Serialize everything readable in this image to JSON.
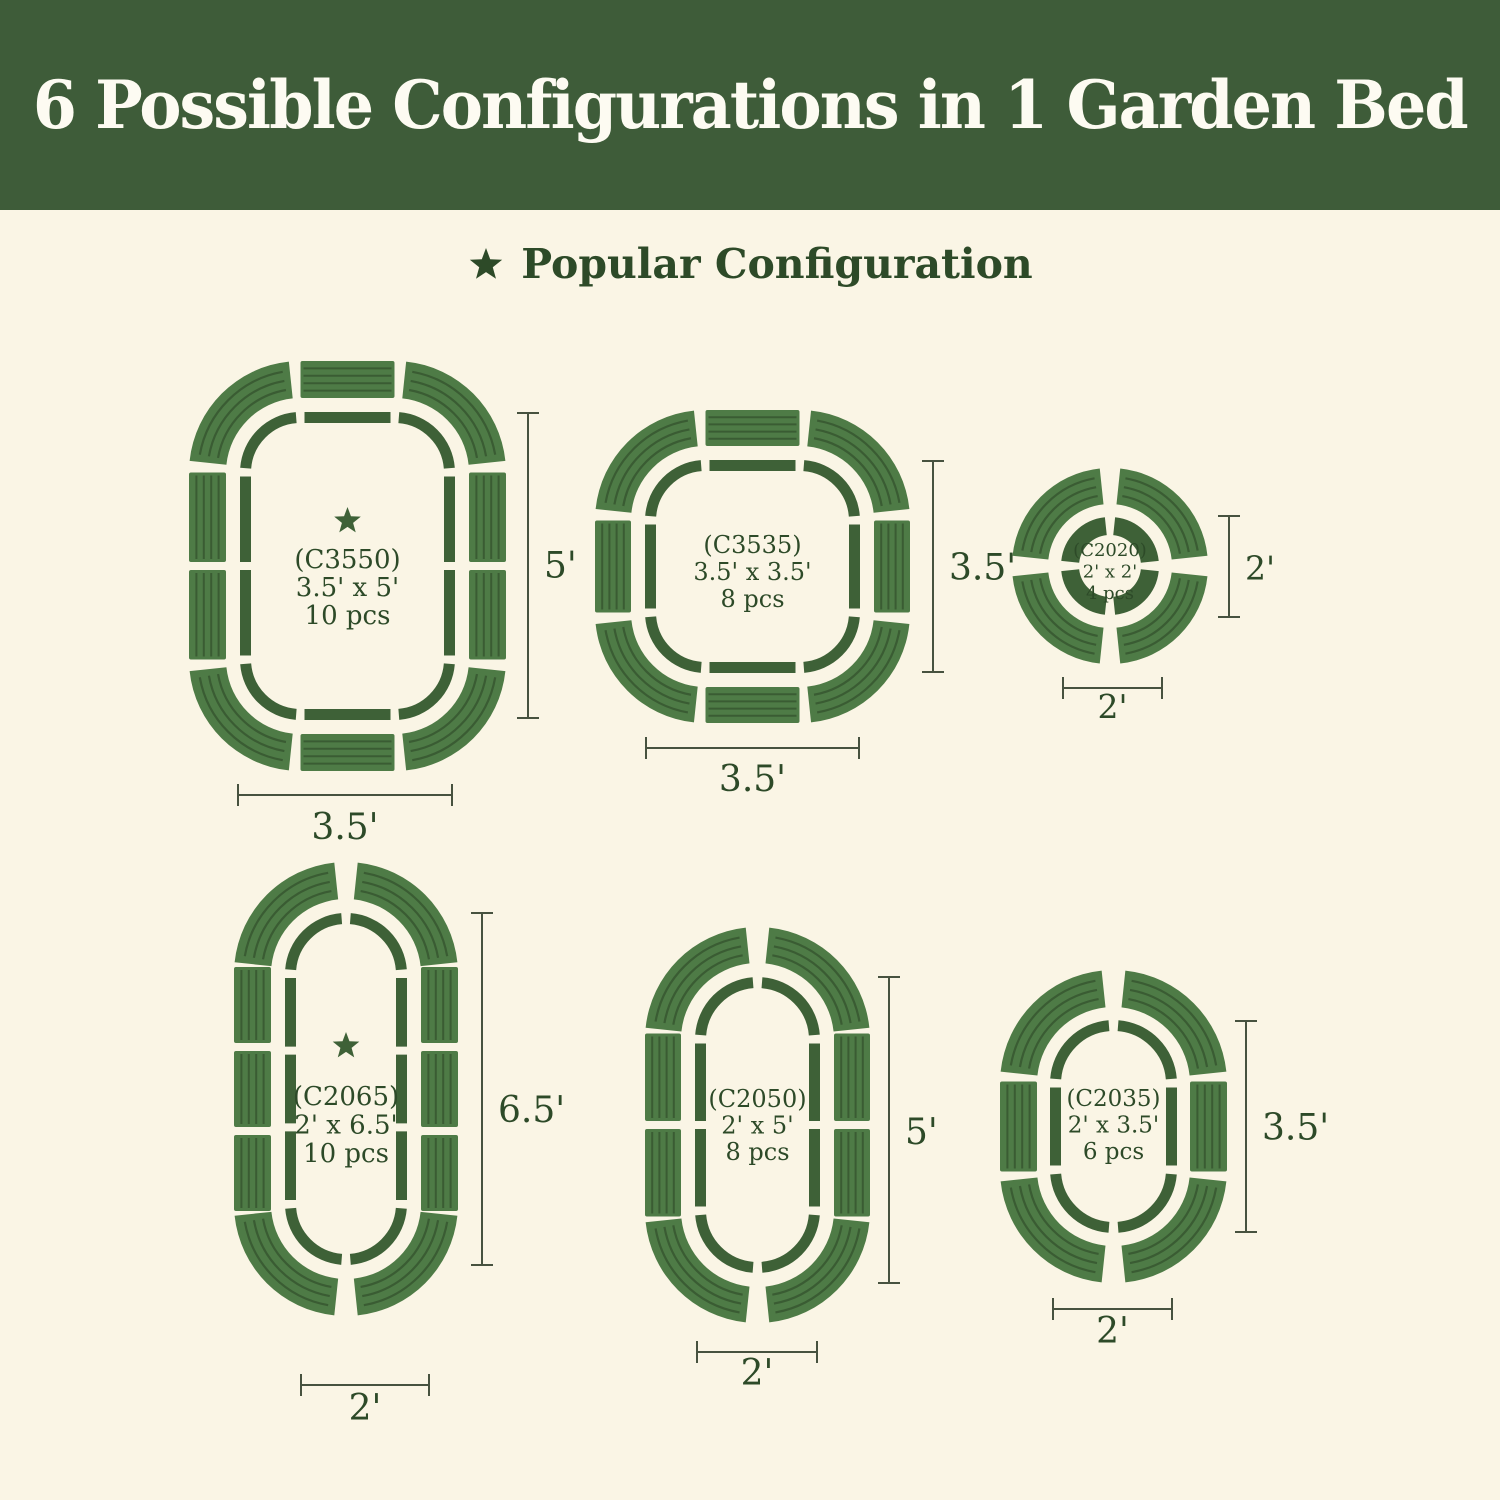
{
  "header": {
    "title": "6 Possible Configurations in 1 Garden Bed"
  },
  "legend": {
    "label": "Popular Configuration"
  },
  "colors": {
    "banner_green": "#3e5c39",
    "track_green": "#3e6137",
    "panel_green": "#4e7b46",
    "ridge_green": "#3a5c33",
    "text_green": "#2d4a28",
    "dimension_line": "#47523f",
    "title_white": "#fdfbf2",
    "background_cream": "#faf5e5"
  },
  "configs": [
    {
      "code": "(C3550)",
      "size": "3.5' x 5'",
      "pieces": "10 pcs",
      "popular": true,
      "height_label": "5'",
      "width_label": "3.5'"
    },
    {
      "code": "(C3535)",
      "size": "3.5' x 3.5'",
      "pieces": "8 pcs",
      "popular": false,
      "height_label": "3.5'",
      "width_label": "3.5'"
    },
    {
      "code": "(C2020)",
      "size": "2' x 2'",
      "pieces": "4 pcs",
      "popular": false,
      "height_label": "2'",
      "width_label": "2'"
    },
    {
      "code": "(C2065)",
      "size": "2' x 6.5'",
      "pieces": "10 pcs",
      "popular": true,
      "height_label": "6.5'",
      "width_label": "2'"
    },
    {
      "code": "(C2050)",
      "size": "2' x 5'",
      "pieces": "8 pcs",
      "popular": false,
      "height_label": "5'",
      "width_label": "2'"
    },
    {
      "code": "(C2035)",
      "size": "2' x 3.5'",
      "pieces": "6 pcs",
      "popular": false,
      "height_label": "3.5'",
      "width_label": "2'"
    }
  ]
}
